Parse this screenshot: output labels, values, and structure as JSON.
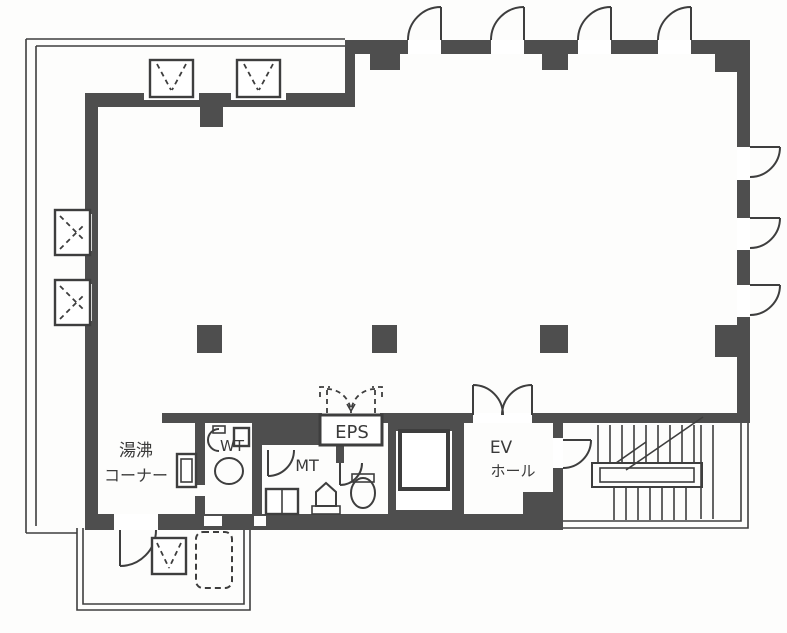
{
  "rooms": {
    "yuwakashi": {
      "line1": "湯沸",
      "line2": "コーナー"
    },
    "wt": {
      "label": "WT"
    },
    "mt": {
      "label": "MT"
    },
    "eps": {
      "label": "EPS"
    },
    "ev_hall": {
      "line1": "EV",
      "line2": "ホール"
    }
  },
  "colors": {
    "wall": "#4e4e4e",
    "line": "#3e3e3e",
    "text": "#3a3a3a",
    "paper": "#fdfdfc"
  }
}
